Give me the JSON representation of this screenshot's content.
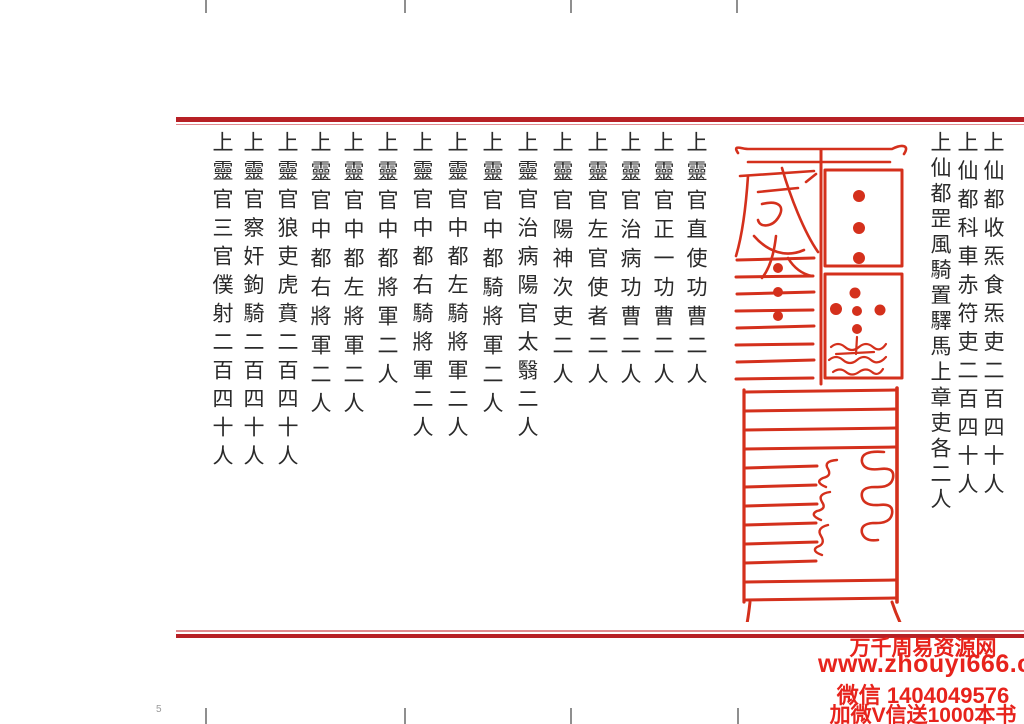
{
  "page": {
    "number": "5",
    "text_color": "#2a2a2a",
    "border_thick_color": "#b72025",
    "border_thin_color": "#e08a8e",
    "talisman_color": "#d4301c",
    "watermark_color": "#e7231c"
  },
  "columns": {
    "right_of_talisman": [
      "上仙都收炁食炁吏二百四十人",
      "上仙都科車赤符吏二百四十人",
      "上仙都罡風騎置驛馬上章吏各二人"
    ],
    "left_of_talisman": [
      "上靈官直使功曹二人",
      "上靈官正一功曹二人",
      "上靈官治病功曹二人",
      "上靈官左官使者二人",
      "上靈官陽神次吏二人",
      "上靈官治病陽官太翳二人",
      "上靈官中都騎將軍二人",
      "上靈官中都左騎將軍二人",
      "上靈官中都右騎將軍二人",
      "上靈官中都將軍二人",
      "上靈官中都左將軍二人",
      "上靈官中都右將軍二人",
      "上靈官狼吏虎賁二百四十人",
      "上靈官察奸鉤騎二百四十人",
      "上靈官三官僕射二百四十人"
    ]
  },
  "watermark": {
    "lines": [
      "万千周易资源网",
      "www.zhouyi666.com",
      "微信 1404049576",
      "加微V信送1000本书"
    ]
  },
  "talisman": {
    "label": "red-talisman-seal"
  }
}
